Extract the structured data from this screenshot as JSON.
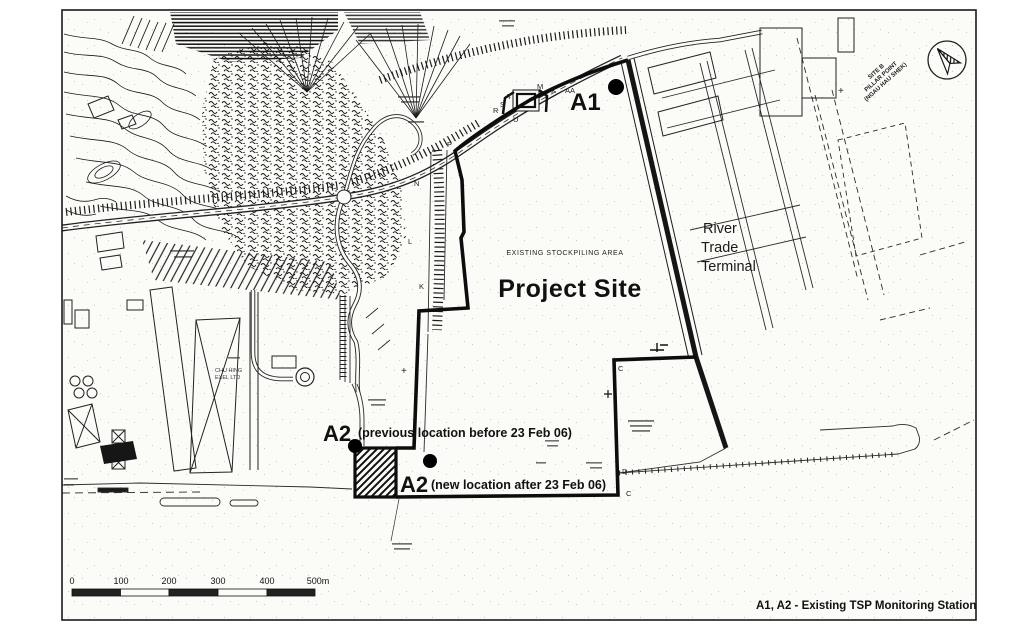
{
  "labels": {
    "stockpiling_area": "EXISTING STOCKPILING AREA",
    "project_site": "Project Site",
    "rtt_1": "River",
    "rtt_2": "Trade",
    "rtt_3": "Terminal",
    "pillar_1": "SITE B",
    "pillar_2": "PILLAR POINT",
    "pillar_3": "(NGAU HAU SHEK)",
    "company_1": "CHU HING",
    "company_2": "EXEL LTD"
  },
  "markers": {
    "a1": {
      "label": "A1"
    },
    "a2_previous": {
      "label": "A2",
      "note": "(previous location before 23 Feb 06)"
    },
    "a2_new": {
      "label": "A2",
      "note": "(new location after 23 Feb 06)"
    }
  },
  "legend": {
    "text": "A1, A2 - Existing TSP Monitoring Station"
  },
  "scale_bar": {
    "ticks": [
      "0",
      "100",
      "200",
      "300",
      "400",
      "500m"
    ]
  },
  "map_letters": [
    "P",
    "N",
    "L",
    "K",
    "R",
    "S",
    "T",
    "U",
    "M",
    "X",
    "AA",
    "D",
    "C",
    "C",
    "+",
    "+"
  ],
  "colors": {
    "ink": "#1a1a1a",
    "paper": "#fbfbf8"
  }
}
